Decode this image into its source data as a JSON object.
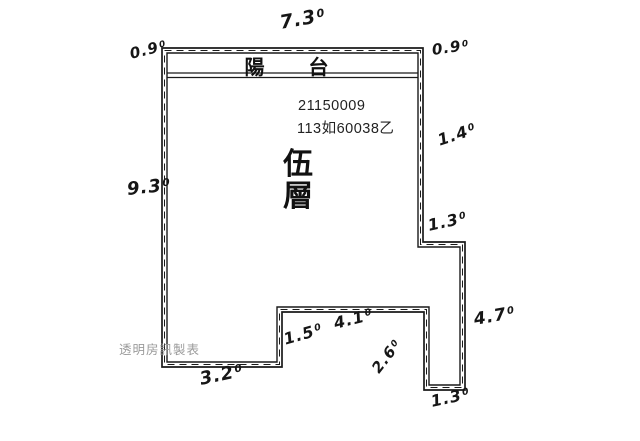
{
  "colors": {
    "wall": "#1a1a1a",
    "ink": "#161616",
    "watermark": "#9a9a9a"
  },
  "plan": {
    "balcony_label": "陽　台",
    "floor_chars": {
      "c1": "伍",
      "c2": "層"
    },
    "registry_no": "21150009",
    "case_no": "113如60038乙",
    "watermark": "透明房訊製表"
  },
  "dimensions": {
    "top": {
      "main": "7.3",
      "sup": "0",
      "value": "7.30"
    },
    "top_left": {
      "main": "0.9",
      "sup": "0",
      "value": "0.90"
    },
    "top_right": {
      "main": "0.9",
      "sup": "0",
      "value": "0.90"
    },
    "right_upper": {
      "main": "1.4",
      "sup": "0",
      "value": "1.40"
    },
    "left": {
      "main": "9.3",
      "sup": "0",
      "value": "9.30"
    },
    "right_step": {
      "main": "1.3",
      "sup": "0",
      "value": "1.30"
    },
    "right_lower": {
      "main": "4.7",
      "sup": "0",
      "value": "4.70"
    },
    "bottom_right": {
      "main": "1.3",
      "sup": "0",
      "value": "1.30"
    },
    "notch_diagonal": {
      "main": "2.6",
      "sup": "0",
      "value": "2.60"
    },
    "bottom_mid": {
      "main": "4.1",
      "sup": "0",
      "value": "4.10"
    },
    "step_height": {
      "main": "1.5",
      "sup": "0",
      "value": "1.50"
    },
    "bottom_left": {
      "main": "3.2",
      "sup": "0",
      "value": "3.20"
    }
  }
}
